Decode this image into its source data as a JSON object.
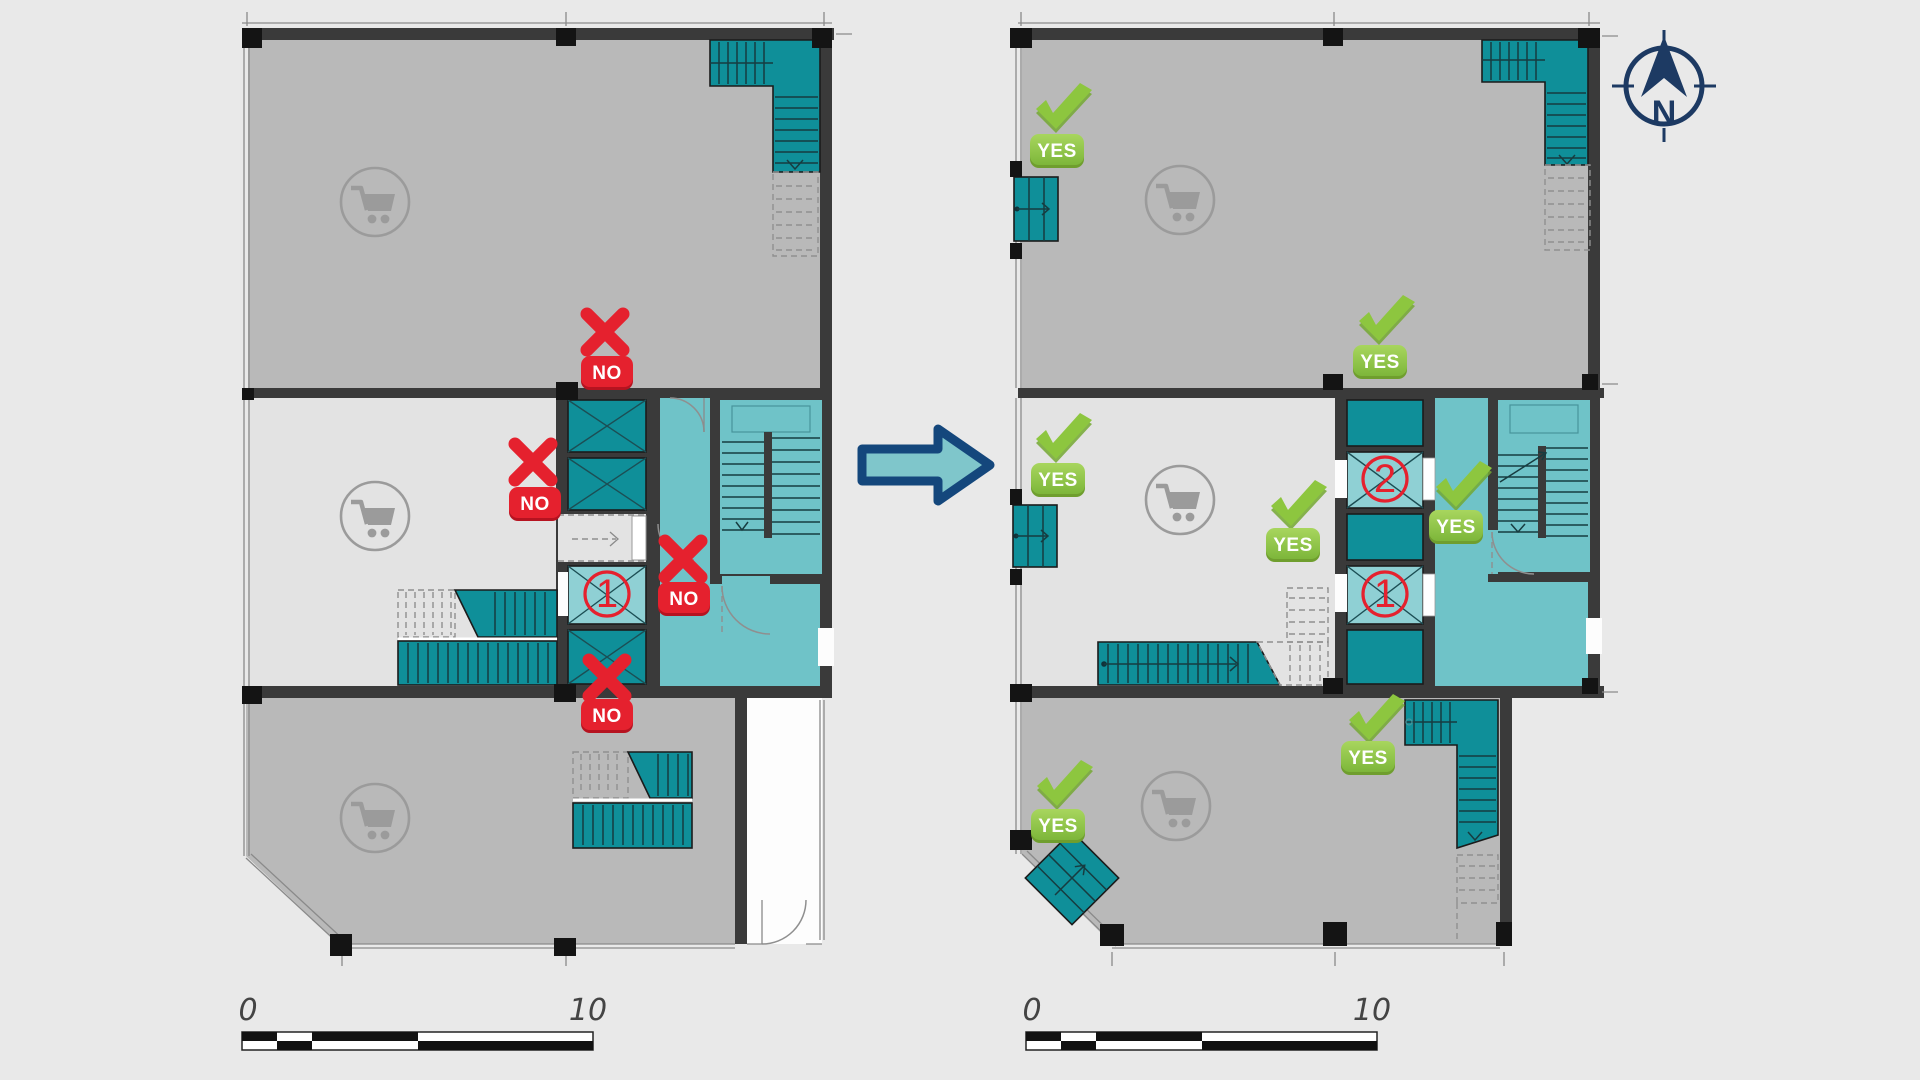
{
  "plans": {
    "before": {
      "no_markers": [
        "NO",
        "NO",
        "NO",
        "NO"
      ],
      "unit_numbers": [
        "1"
      ]
    },
    "after": {
      "yes_markers": [
        "YES",
        "YES",
        "YES",
        "YES",
        "YES",
        "YES",
        "YES"
      ],
      "unit_numbers": [
        "2",
        "1"
      ]
    }
  },
  "compass": {
    "north_label": "N"
  },
  "scale_bars": [
    {
      "min": "0",
      "max": "10"
    },
    {
      "min": "0",
      "max": "10"
    }
  ],
  "icons": {
    "cart": "shopping-cart-icon",
    "check": "checkmark-icon",
    "cross": "x-icon",
    "compass": "north-compass-icon"
  },
  "colors": {
    "background": "#e9e9e9",
    "room_gray": "#b9b9b9",
    "room_light_gray": "#e3e3e3",
    "wall_dark": "#3a3a3a",
    "teal_dark": "#0f8f99",
    "teal_lobby": "#6fc3c8",
    "teal_unit": "#8fd0d4",
    "no_red": "#e5212e",
    "yes_green": "#8dc63f",
    "navy": "#1d3a63"
  }
}
